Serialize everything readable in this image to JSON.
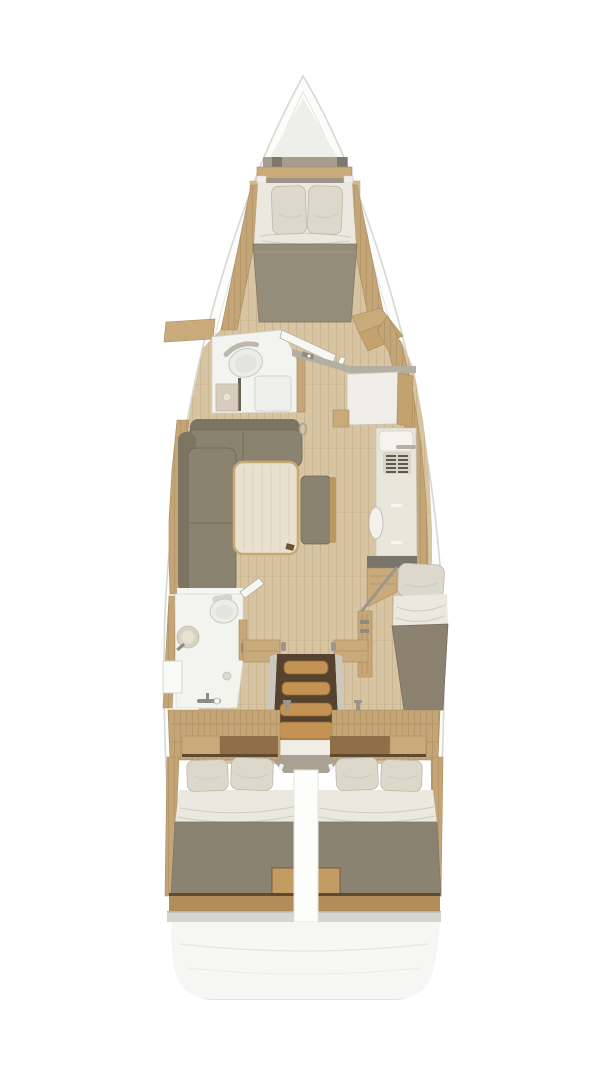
{
  "diagram": {
    "type": "sailboat-interior-floor-plan",
    "orientation": "bow-up",
    "areas": [
      {
        "id": "bow-locker"
      },
      {
        "id": "forward-cabin-v-berth"
      },
      {
        "id": "forward-head-bathroom"
      },
      {
        "id": "saloon-l-sofa-and-table"
      },
      {
        "id": "galley-counter"
      },
      {
        "id": "aft-head-bathroom"
      },
      {
        "id": "companionway-stairs"
      },
      {
        "id": "starboard-single-berth"
      },
      {
        "id": "aft-cabin-port-double-berth"
      },
      {
        "id": "aft-cabin-starboard-double-berth"
      },
      {
        "id": "stern-deck"
      }
    ]
  },
  "colors": {
    "hull_fill": "#fcfcfb",
    "hull_line": "#d7d7d3",
    "hull_inner_line": "#e6e6e2",
    "bow_shade": "#eeeeeb",
    "floor_wood": "#d6c4a3",
    "floor_line": "#c2ab80",
    "deck_wood": "#c3a577",
    "deck_line": "#a98b5c",
    "wood_light": "#c9aa7b",
    "wood_mid": "#b28c59",
    "wood_dark": "#8f6f48",
    "wood_edge_dark": "#5e4a2f",
    "door_wood": "#c7a677",
    "stair_wood": "#c49252",
    "stair_edge": "#8a6534",
    "stair_well": "#55432f",
    "sofa": "#8a8370",
    "sofa_back": "#7c7562",
    "sofa_dark": "#6e6755",
    "table_top": "#e8e1d0",
    "table_edge": "#c8a873",
    "mattress": "#8a8371",
    "mattress_fwd": "#948d7a",
    "blanket": "#8b8270",
    "pillow": "#dcd8cb",
    "pillow_line": "#b9b4a5",
    "bedding": "#eae8df",
    "fold_line": "#cfccc0",
    "bath_floor": "#f3f3ef",
    "fixture": "#ffffff",
    "fixture_line": "#c9c9c3",
    "sink_beige": "#d6cdbc",
    "counter": "#e9e6db",
    "counter_end": "#7a756a",
    "vent_slat": "#5f5a50",
    "grey_trim": "#a9a294",
    "rail_grey": "#b3afa2",
    "handle_grey": "#8f8b80",
    "grey_band": "#d6d5d0",
    "white_soft": "#f6f6f3",
    "stern_fill": "#f6f6f4"
  }
}
